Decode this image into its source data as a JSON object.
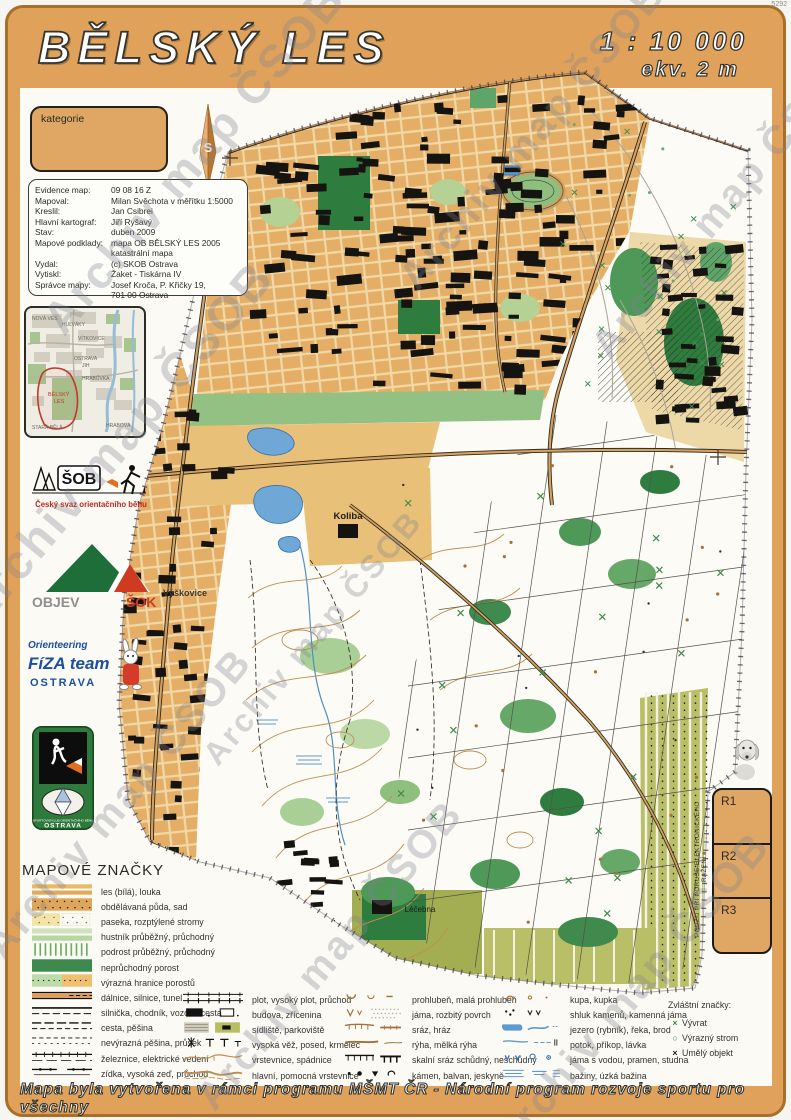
{
  "watermark": {
    "text": "Archiv map ČSOB"
  },
  "corner_note": "5292",
  "header": {
    "title": "BĚLSKÝ LES",
    "scale": "1 : 10 000",
    "equidistance": "ekv. 2 m"
  },
  "kategorie_box": {
    "label": "kategorie"
  },
  "north_arrow": {
    "label": "S"
  },
  "metadata": {
    "rows": [
      {
        "k": "Evidence map:",
        "v": "09 08 16 Z"
      },
      {
        "k": "Mapoval:",
        "v": "Milan Svěchota v měřítku 1:5000"
      },
      {
        "k": "Kreslil:",
        "v": "Jan Csibrei"
      },
      {
        "k": "Hlavní kartograf:",
        "v": "Jiří Ryšavý"
      },
      {
        "k": "Stav:",
        "v": "duben 2009"
      },
      {
        "k": "Mapové podklady:",
        "v": "mapa OB BĚLSKÝ LES 2005"
      },
      {
        "k": "",
        "v": "katastrální mapa"
      },
      {
        "k": "Vydal:",
        "v": "(c) SKOB Ostrava"
      },
      {
        "k": "Vytiskl:",
        "v": "Žaket - Tiskárna IV"
      },
      {
        "k": "Správce mapy:",
        "v": "Josef Kroča, P. Křičky 19,"
      },
      {
        "k": "",
        "v": "701 00 Ostrava"
      }
    ]
  },
  "inset_map": {
    "labels": [
      "NOVÁ VES",
      "HULVÁKY",
      "VÍTKOVICE",
      "OSTRAVA",
      "JIH",
      "HRABŮVKA",
      "BĚLSKÝ",
      "LES",
      "STARÁ BĚLÁ",
      "HRABOVÁ"
    ]
  },
  "logos": {
    "csob": {
      "acronym": "ŠOB",
      "caption": "Český svaz orientačního běhu"
    },
    "objev_sok": {
      "left": "OBJEV",
      "right": "ŠOK"
    },
    "fiza": {
      "line1": "Orienteering",
      "line2": "FíZA team",
      "line3": "OSTRAVA"
    },
    "skob": {
      "small": "SPORTOVNÍ KLUB ORIENTAČNÍHO BĚHU",
      "city": "OSTRAVA"
    }
  },
  "map_labels": {
    "koliba": "Koliba",
    "vyskovice": "Výškovice",
    "lecebna": "Léčebna"
  },
  "legend": {
    "title": "MAPOVÉ ZNAČKY",
    "col1": [
      "les (bílá), louka",
      "obdělávaná půda, sad",
      "paseka, rozptýlené stromy",
      "hustník průběžný, průchodný",
      "podrost průběžný, průchodný",
      "neprůchodný porost",
      "výrazná hranice porostů",
      "dálnice, silnice, tunel",
      "silnička, chodník, vozová cesta",
      "cesta, pěšina",
      "nevýrazná pěšina, průsek",
      "železnice, elektrické vedení",
      "zídka, vysoká zeď, průchod"
    ],
    "col2": [
      "plot, vysoký plot, průchod",
      "budova, zřícenina",
      "sídliště, parkoviště",
      "vysoká věž, posed, krmelec",
      "vrstevnice, spádnice",
      "hlavní, pomocná vrstevnice"
    ],
    "col3": [
      "prohlubeň, malá prohlubeň",
      "jáma, rozbitý povrch",
      "sráz, hráz",
      "rýha, mělká rýha",
      "skalní sráz schůdný, neschůdný",
      "kámen, balvan, jeskyně"
    ],
    "col4": [
      "kupa, kupka",
      "shluk kamenů, kamenná jáma",
      "jezero (rybník), řeka, brod",
      "potok, příkop, lávka",
      "jáma s vodou, pramen, studna",
      "bažiny, úzká bažina"
    ],
    "special": {
      "title": "Zvláštní značky:",
      "items": [
        "Vývrat",
        "Výrazný strom",
        "Umělý objekt"
      ]
    }
  },
  "controls": {
    "vertical_text": "POUŽIJ PŘI PORUŠE ELEKTRONICKÉHO RAŽENÍ",
    "boxes": [
      "R1",
      "R2",
      "R3"
    ]
  },
  "footer": {
    "text": "Mapa byla vytvořena v rámci programu MŠMT ČR - Národní program rozvoje sportu pro všechny"
  },
  "colors": {
    "frame": "#e0a25a",
    "box_fill": "#dfa763",
    "urban": "#e4ae66",
    "forest_green": "#3e8a4e",
    "water": "#6fa8d6"
  }
}
